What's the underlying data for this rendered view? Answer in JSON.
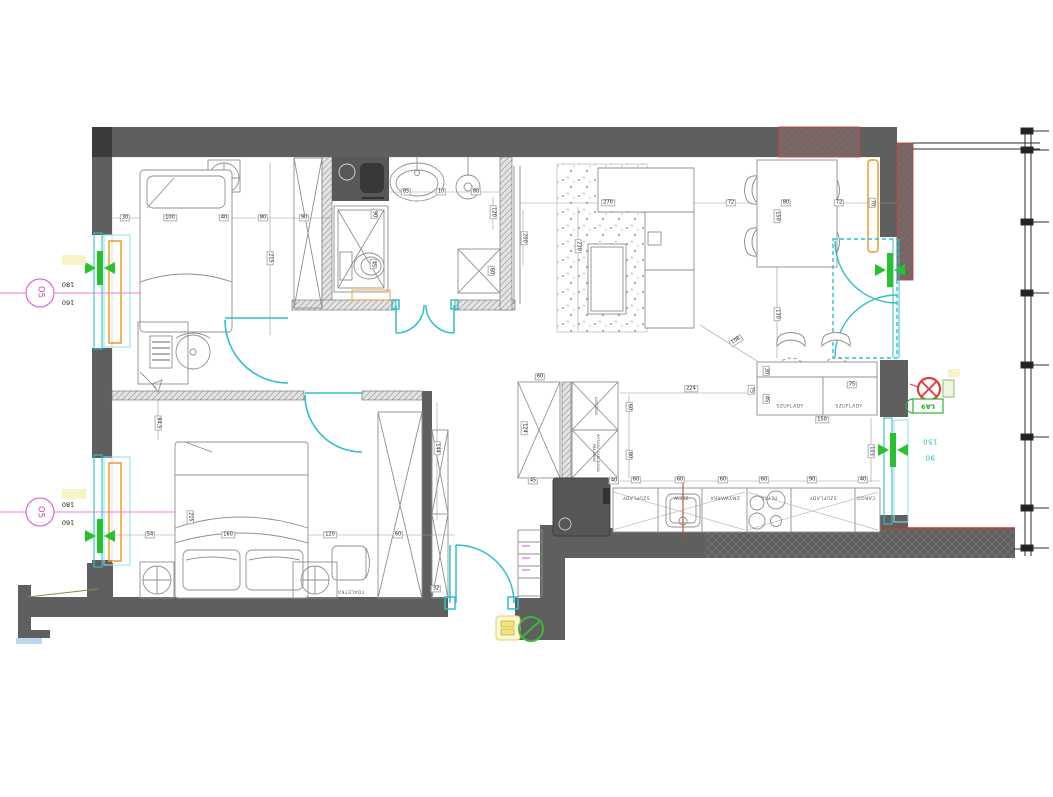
{
  "type": "architectural-floor-plan",
  "colors": {
    "wall": "#5f5f5f",
    "wall_dark": "#3b3b3b",
    "door_window_teal": "#2fc0cc",
    "opening_marker_green": "#29c12e",
    "radiator_orange": "#ef9b28",
    "window_tag_magenta": "#d94fd0",
    "hatch_red": "#c24444",
    "symbol_red": "#e23b3b"
  },
  "window_tags": {
    "left_tag": "O5",
    "left_sizes": [
      "180",
      "160"
    ],
    "right_sizes": [
      "150",
      "90"
    ],
    "lamp_tag": "LA9"
  },
  "labels": [
    {
      "t": "O5",
      "x": 40,
      "y": 292,
      "r": 90,
      "c": "tag"
    },
    {
      "t": "180",
      "x": 68,
      "y": 284,
      "r": 180,
      "c": "plain"
    },
    {
      "t": "160",
      "x": 68,
      "y": 302,
      "r": 180,
      "c": "plain"
    },
    {
      "t": "O5",
      "x": 40,
      "y": 512,
      "r": 90,
      "c": "tag"
    },
    {
      "t": "180",
      "x": 68,
      "y": 504,
      "r": 180,
      "c": "plain"
    },
    {
      "t": "160",
      "x": 68,
      "y": 522,
      "r": 180,
      "c": "plain"
    },
    {
      "t": "150",
      "x": 930,
      "y": 441,
      "r": 180,
      "c": "teal"
    },
    {
      "t": "90",
      "x": 930,
      "y": 457,
      "r": 180,
      "c": "teal"
    },
    {
      "t": "LA9",
      "x": 928,
      "y": 406,
      "r": 180,
      "c": "green"
    },
    {
      "t": "30",
      "x": 125,
      "y": 218,
      "r": 0,
      "c": "dim"
    },
    {
      "t": "100",
      "x": 170,
      "y": 218,
      "r": 0,
      "c": "dim"
    },
    {
      "t": "40",
      "x": 224,
      "y": 218,
      "r": 0,
      "c": "dim"
    },
    {
      "t": "80",
      "x": 263,
      "y": 218,
      "r": 0,
      "c": "dim"
    },
    {
      "t": "90",
      "x": 304,
      "y": 218,
      "r": 0,
      "c": "dim"
    },
    {
      "t": "215",
      "x": 270,
      "y": 258,
      "r": 90,
      "c": "dim"
    },
    {
      "t": "85",
      "x": 406,
      "y": 192,
      "r": 0,
      "c": "dim"
    },
    {
      "t": "10",
      "x": 441,
      "y": 192,
      "r": 0,
      "c": "dim"
    },
    {
      "t": "80",
      "x": 476,
      "y": 192,
      "r": 0,
      "c": "dim"
    },
    {
      "t": "90",
      "x": 374,
      "y": 214,
      "r": 90,
      "c": "dim"
    },
    {
      "t": "120",
      "x": 493,
      "y": 212,
      "r": 90,
      "c": "dim"
    },
    {
      "t": "200",
      "x": 524,
      "y": 238,
      "r": 90,
      "c": "dim"
    },
    {
      "t": "60",
      "x": 491,
      "y": 271,
      "r": 90,
      "c": "dim"
    },
    {
      "t": "45",
      "x": 373,
      "y": 264,
      "r": 90,
      "c": "dim"
    },
    {
      "t": "270",
      "x": 608,
      "y": 203,
      "r": 0,
      "c": "dim"
    },
    {
      "t": "72",
      "x": 731,
      "y": 203,
      "r": 0,
      "c": "dim"
    },
    {
      "t": "80",
      "x": 786,
      "y": 203,
      "r": 0,
      "c": "dim"
    },
    {
      "t": "72",
      "x": 839,
      "y": 203,
      "r": 0,
      "c": "dim"
    },
    {
      "t": "70",
      "x": 872,
      "y": 203,
      "r": 90,
      "c": "dim"
    },
    {
      "t": "150",
      "x": 777,
      "y": 216,
      "r": 90,
      "c": "dim"
    },
    {
      "t": "230",
      "x": 578,
      "y": 246,
      "r": 90,
      "c": "dim"
    },
    {
      "t": "130",
      "x": 777,
      "y": 314,
      "r": 90,
      "c": "dim"
    },
    {
      "t": "108",
      "x": 736,
      "y": 341,
      "r": -32,
      "c": "dim"
    },
    {
      "t": "103",
      "x": 871,
      "y": 451,
      "r": 90,
      "c": "dim"
    },
    {
      "t": "224",
      "x": 691,
      "y": 389,
      "r": 0,
      "c": "dim"
    },
    {
      "t": "75",
      "x": 852,
      "y": 385,
      "r": 0,
      "c": "dim"
    },
    {
      "t": "150",
      "x": 822,
      "y": 420,
      "r": 0,
      "c": "dim"
    },
    {
      "t": "30",
      "x": 766,
      "y": 371,
      "r": 90,
      "c": "dim"
    },
    {
      "t": "45",
      "x": 766,
      "y": 399,
      "r": 90,
      "c": "dim"
    },
    {
      "t": "75",
      "x": 751,
      "y": 390,
      "r": 90,
      "c": "dim"
    },
    {
      "t": "60",
      "x": 540,
      "y": 377,
      "r": 0,
      "c": "dim"
    },
    {
      "t": "124",
      "x": 524,
      "y": 428,
      "r": 90,
      "c": "dim"
    },
    {
      "t": "60",
      "x": 629,
      "y": 407,
      "r": 90,
      "c": "dim"
    },
    {
      "t": "80",
      "x": 629,
      "y": 455,
      "r": 90,
      "c": "dim"
    },
    {
      "t": "45",
      "x": 533,
      "y": 481,
      "r": 0,
      "c": "dim"
    },
    {
      "t": "40",
      "x": 614,
      "y": 481,
      "r": 0,
      "c": "dim"
    },
    {
      "t": "60",
      "x": 636,
      "y": 480,
      "r": 0,
      "c": "dim"
    },
    {
      "t": "60",
      "x": 680,
      "y": 480,
      "r": 0,
      "c": "dim"
    },
    {
      "t": "60",
      "x": 723,
      "y": 480,
      "r": 0,
      "c": "dim"
    },
    {
      "t": "60",
      "x": 764,
      "y": 480,
      "r": 0,
      "c": "dim"
    },
    {
      "t": "90",
      "x": 812,
      "y": 480,
      "r": 0,
      "c": "dim"
    },
    {
      "t": "40",
      "x": 863,
      "y": 480,
      "r": 0,
      "c": "dim"
    },
    {
      "t": "84,5",
      "x": 158,
      "y": 423,
      "r": 90,
      "c": "dim"
    },
    {
      "t": "215",
      "x": 190,
      "y": 517,
      "r": 90,
      "c": "dim"
    },
    {
      "t": "54",
      "x": 150,
      "y": 535,
      "r": 0,
      "c": "dim"
    },
    {
      "t": "160",
      "x": 228,
      "y": 535,
      "r": 0,
      "c": "dim"
    },
    {
      "t": "120",
      "x": 330,
      "y": 535,
      "r": 0,
      "c": "dim"
    },
    {
      "t": "60",
      "x": 398,
      "y": 535,
      "r": 0,
      "c": "dim"
    },
    {
      "t": "144",
      "x": 437,
      "y": 448,
      "r": 90,
      "c": "dim"
    },
    {
      "t": "32",
      "x": 436,
      "y": 589,
      "r": 0,
      "c": "dim"
    },
    {
      "t": "SZUFLADY",
      "x": 636,
      "y": 496,
      "r": 180,
      "c": "cab"
    },
    {
      "t": "ZLEW",
      "x": 681,
      "y": 496,
      "r": 180,
      "c": "cab"
    },
    {
      "t": "ZMYWARKA",
      "x": 725,
      "y": 496,
      "r": 180,
      "c": "cab"
    },
    {
      "t": "PŁYTA",
      "x": 769,
      "y": 496,
      "r": 180,
      "c": "cab"
    },
    {
      "t": "SZUFLADY",
      "x": 823,
      "y": 496,
      "r": 180,
      "c": "cab"
    },
    {
      "t": "CARGO",
      "x": 866,
      "y": 496,
      "r": 180,
      "c": "cab"
    },
    {
      "t": "SZUFLADY",
      "x": 790,
      "y": 408,
      "r": 0,
      "c": "cab"
    },
    {
      "t": "SZUFLADY",
      "x": 849,
      "y": 408,
      "r": 0,
      "c": "cab"
    },
    {
      "t": "LODÓWKA",
      "x": 595,
      "y": 406,
      "r": 90,
      "c": "cabv"
    },
    {
      "t": "WYSOKA ZABUDOWA PIEKARNIK",
      "x": 595,
      "y": 453,
      "r": 90,
      "c": "cabv"
    },
    {
      "t": "TOALETKA",
      "x": 351,
      "y": 590,
      "r": 180,
      "c": "cab"
    }
  ]
}
